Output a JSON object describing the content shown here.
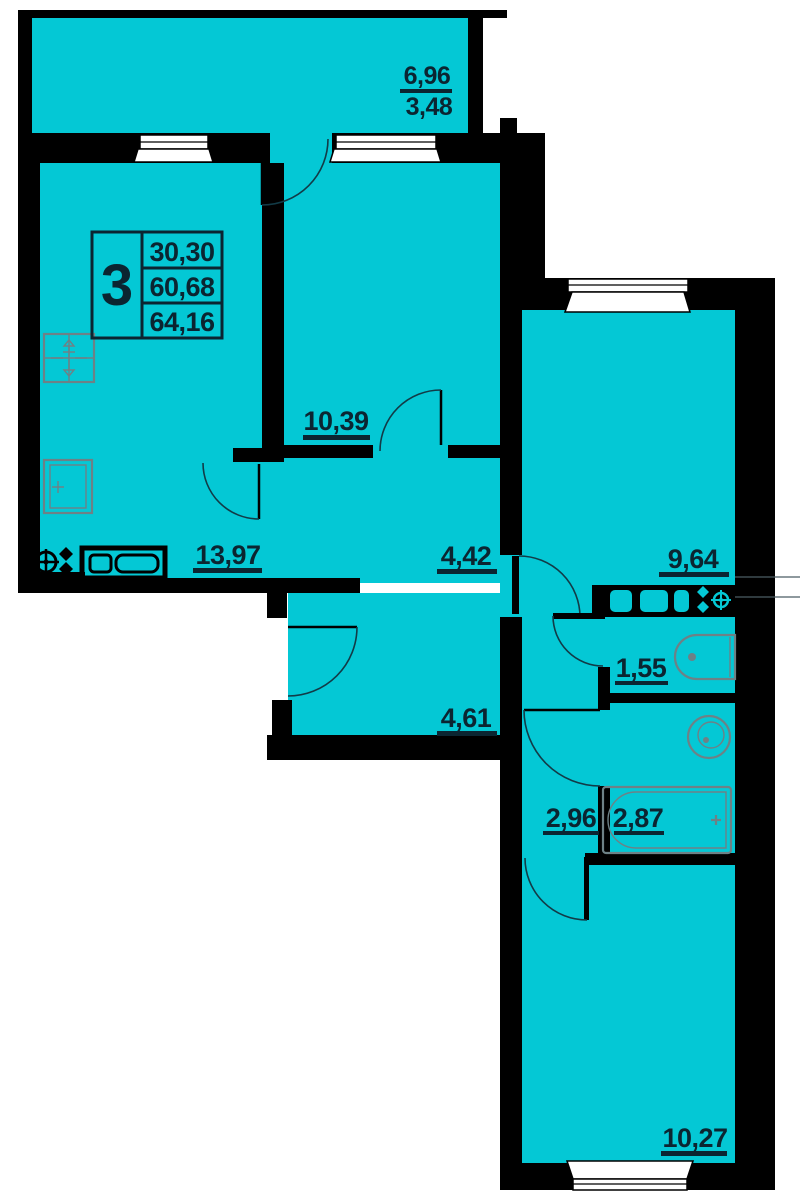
{
  "plan_title": "3-room apartment floor plan",
  "badge": {
    "room_count": "3",
    "living_area": "30,30",
    "floor_area": "60,68",
    "total_area": "64,16"
  },
  "balcony": {
    "area_full": "6,96",
    "area_counted": "3,48"
  },
  "areas": {
    "kitchen": "13,97",
    "room_mid": "10,39",
    "hall_top": "4,42",
    "hall_entry": "4,61",
    "room_right_top": "9,64",
    "wc": "1,55",
    "hall_right": "2,96",
    "bath": "2,87",
    "room_right_bottom": "10,27"
  },
  "fixtures": [
    "stove-icon",
    "cabinet-icon",
    "kitchen-sink-icon",
    "kitchen-counter-icon",
    "counter-right-icon",
    "sink-right-icon",
    "toilet-icon",
    "washbasin-icon",
    "bathtub-icon"
  ],
  "colors": {
    "floor": "#04c8d5",
    "wall": "#000000",
    "text": "#0b2531",
    "fixture_gray": "#6e8186",
    "door_arc": "#123b47",
    "background": "#ffffff"
  }
}
